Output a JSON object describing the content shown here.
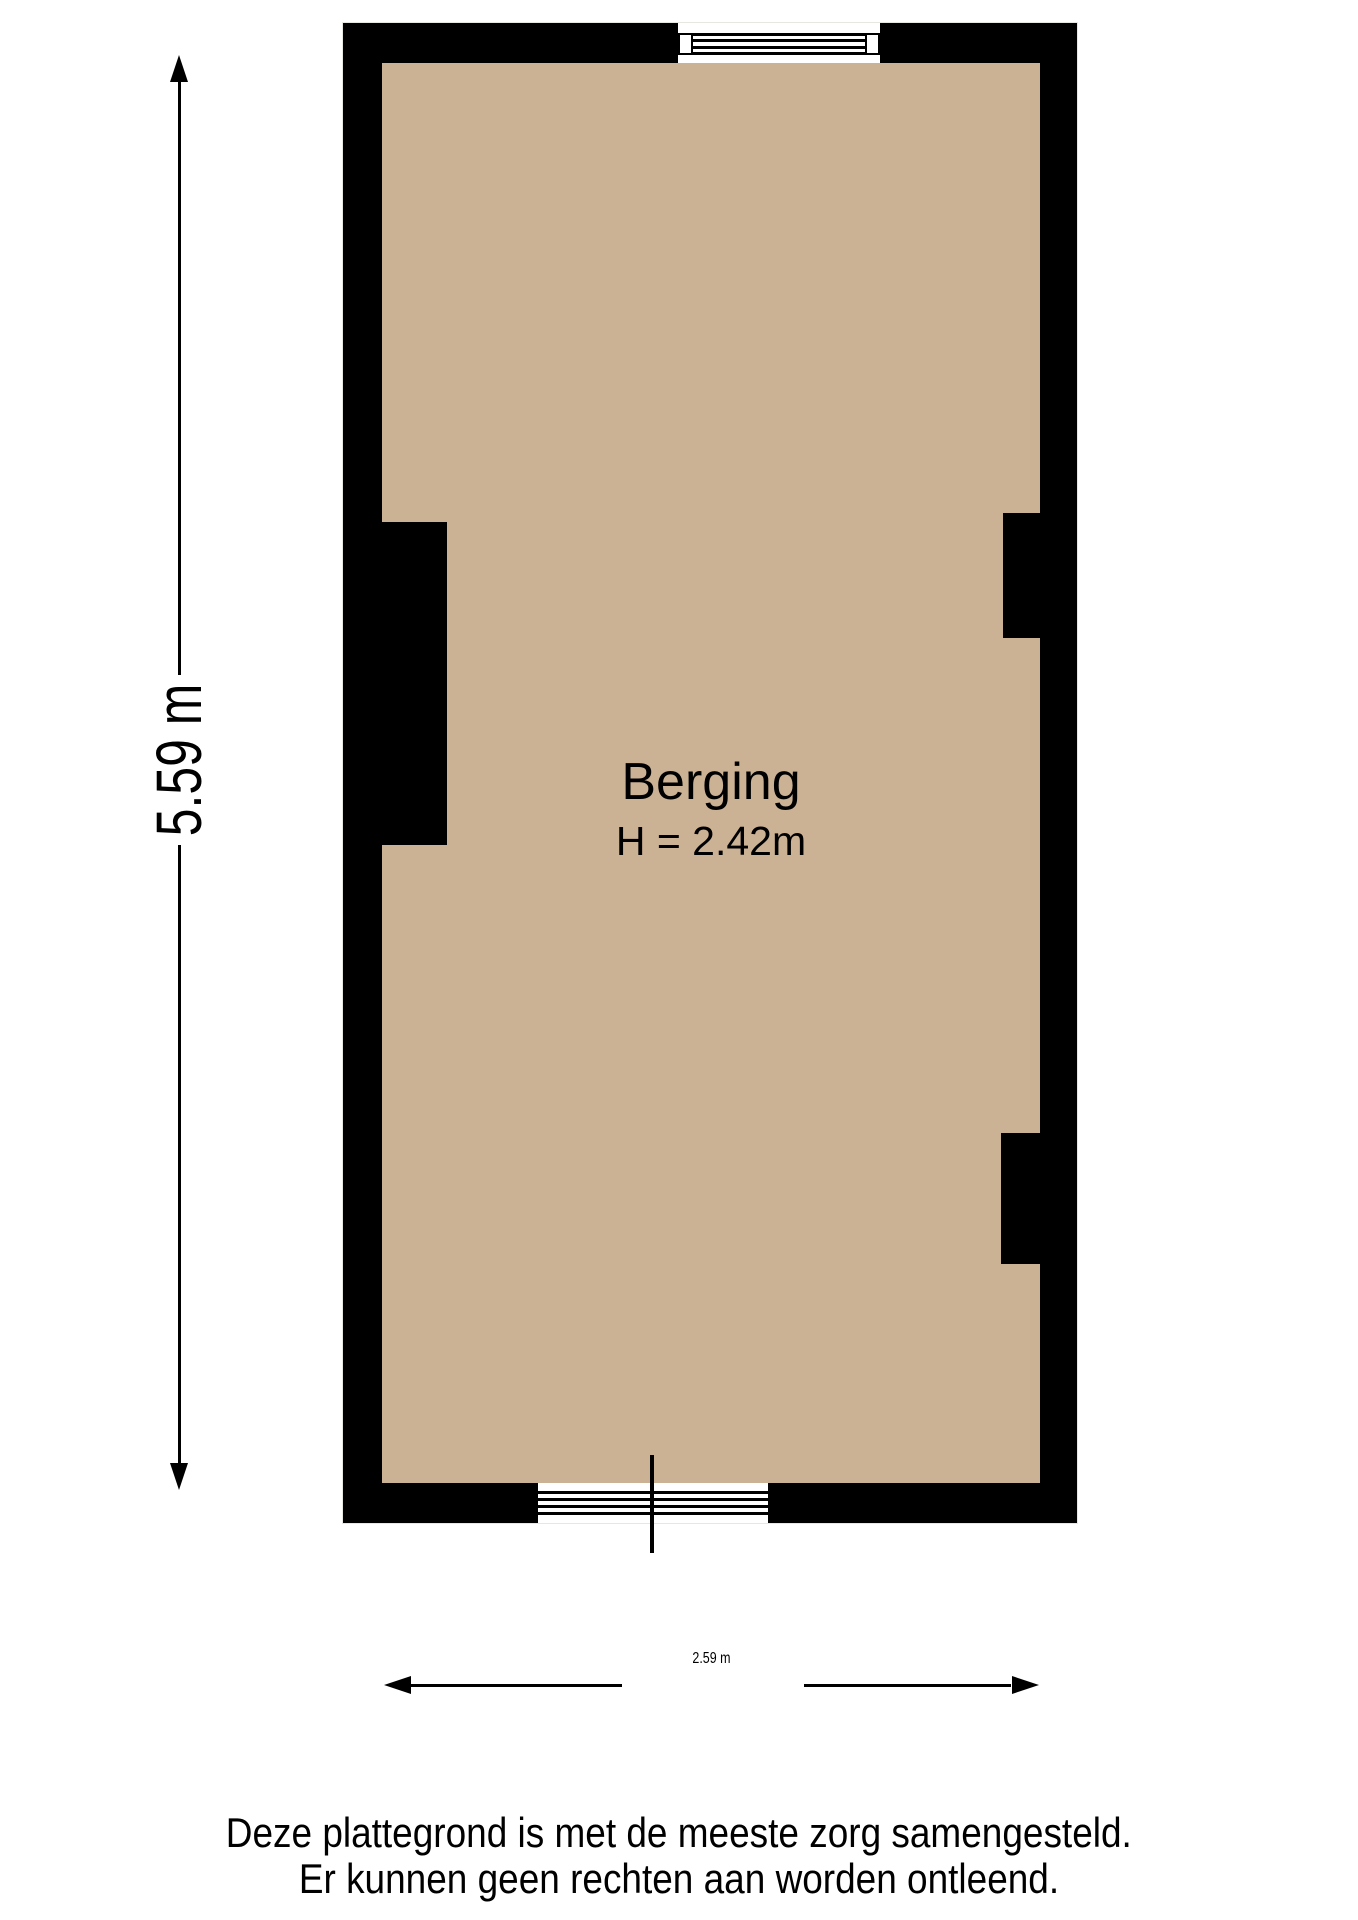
{
  "plan": {
    "room": {
      "name": "Berging",
      "height_label": "H = 2.42m"
    },
    "dimensions": {
      "vertical": "5.59 m",
      "horizontal": "2.59 m"
    },
    "colors": {
      "wall": "#000000",
      "floor": "#ccb294",
      "background": "#ffffff"
    }
  },
  "footer": {
    "disclaimer_line1": "Deze plattegrond is met de meeste zorg samengesteld.",
    "disclaimer_line2": "Er kunnen geen rechten aan worden ontleend."
  }
}
